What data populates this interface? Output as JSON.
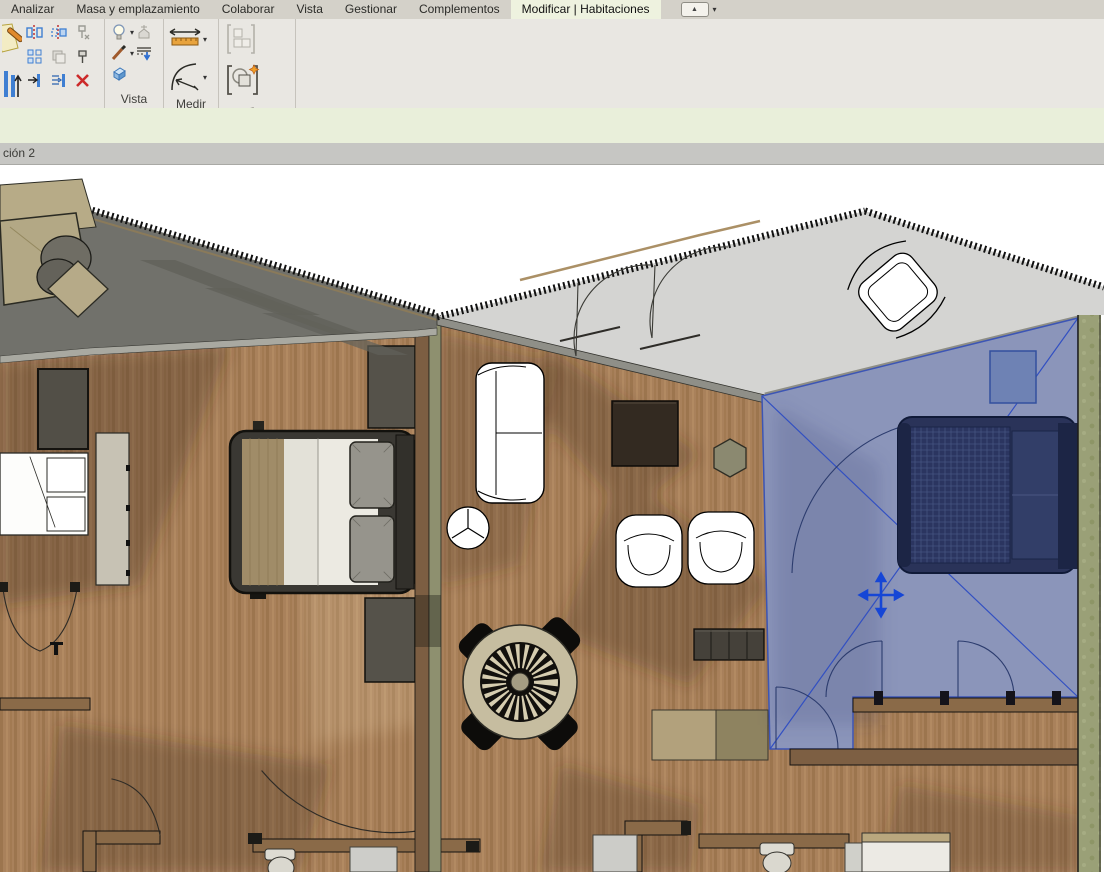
{
  "tabs": {
    "items": [
      {
        "label": "Analizar",
        "active": false
      },
      {
        "label": "Masa y emplazamiento",
        "active": false
      },
      {
        "label": "Colaborar",
        "active": false
      },
      {
        "label": "Vista",
        "active": false
      },
      {
        "label": "Gestionar",
        "active": false
      },
      {
        "label": "Complementos",
        "active": false
      },
      {
        "label": "Modificar | Habitaciones",
        "active": true
      }
    ]
  },
  "icons": {
    "collapse_glyph": "▲",
    "caret_glyph": "▾"
  },
  "ribbon": {
    "panels": [
      {
        "label": "r"
      },
      {
        "label": "Vista"
      },
      {
        "label": "Medir"
      },
      {
        "label": "Crear"
      }
    ]
  },
  "view_bar": {
    "title": "ción 2"
  },
  "selection": {
    "element": "room",
    "highlight_color": "#4a5fb0",
    "marker": "move-cross"
  },
  "colors": {
    "tabbar_bg": "#d4d1c9",
    "active_tab_bg": "#eef2df",
    "ribbon_bg": "#e9e7e2",
    "strip_bg": "#e9efda",
    "title_bg": "#c6c6c3",
    "roof_dark": "#71716b",
    "roof_light": "#d4d4d2",
    "wood_floor": "#a9815b",
    "green_wall": "#9aa077",
    "blue_overlay": "#5a6daa",
    "delete_red": "#cc2a2a"
  }
}
